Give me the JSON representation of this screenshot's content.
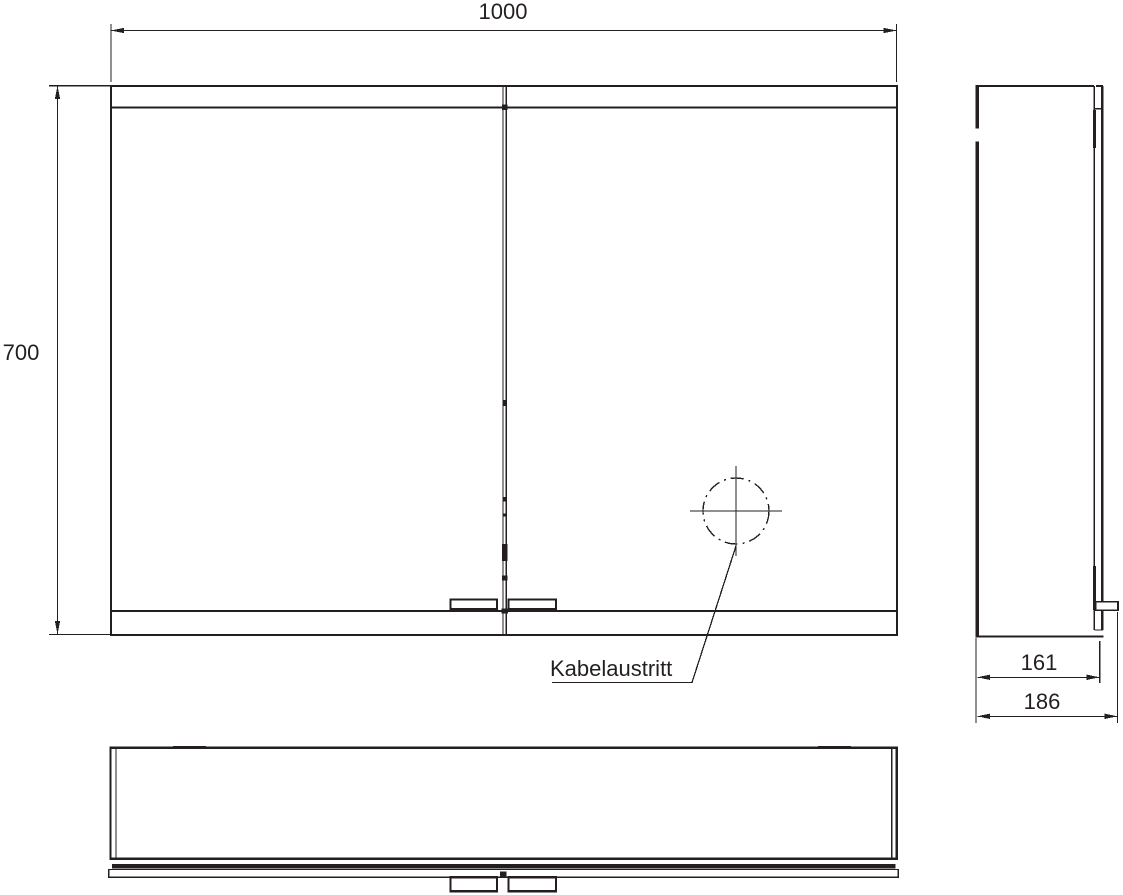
{
  "drawing": {
    "type": "technical-dimension-drawing",
    "subject": "mirror-cabinet three-view drawing",
    "colors": {
      "line": "#231f20",
      "background": "#ffffff"
    }
  },
  "dimensions": {
    "width": {
      "value": "1000"
    },
    "height": {
      "value": "700"
    },
    "depth_body": {
      "value": "161"
    },
    "depth_overall": {
      "value": "186"
    }
  },
  "annotations": {
    "cable_outlet": {
      "label": "Kabelaustritt"
    }
  }
}
